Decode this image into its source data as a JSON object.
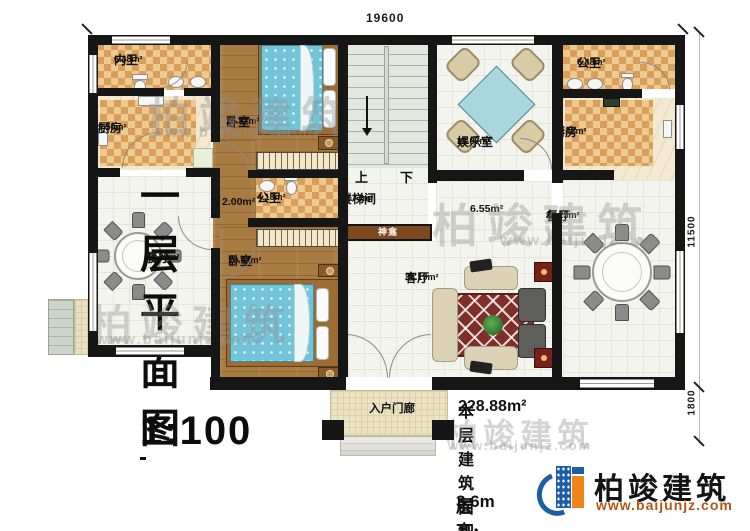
{
  "plan": {
    "dimensions": {
      "width_top": "19600",
      "height_right": "11500",
      "porch_right": "1800"
    },
    "rooms": {
      "inner_bath": {
        "name": "内卫",
        "area": "6.48m²"
      },
      "kitchen_left": {
        "name": "厨房",
        "area": "9.50m²"
      },
      "bedroom_top": {
        "name": "卧室",
        "area": "15.87m²"
      },
      "bath_center": {
        "name": "公卫",
        "area": "4.18m²"
      },
      "corridor_small": {
        "area": "2.00m²"
      },
      "stairwell": {
        "name": "楼梯间",
        "area": "16.73m²"
      },
      "shrine": {
        "name": "神龛"
      },
      "entertainment": {
        "name": "娱乐室",
        "area": "16.87m²"
      },
      "bath_right": {
        "name": "公卫",
        "area": "6.48m²"
      },
      "kitchen_right": {
        "name": "厨房",
        "area": "10.42m²"
      },
      "dining_left": {
        "name": "餐厅",
        "area": "22.23m²"
      },
      "bedroom_bottom": {
        "name": "卧室",
        "area": "19.64m²"
      },
      "living": {
        "name": "客厅",
        "area": "36.19m²"
      },
      "corridor_mid": {
        "area": "6.55m²"
      },
      "dining_right": {
        "name": "餐厅",
        "area": "22.23m²"
      },
      "porch": {
        "name": "入户门廊"
      }
    },
    "stairs": {
      "up": "上",
      "down": "下"
    }
  },
  "watermark": {
    "text": "柏竣建筑",
    "url": "www.baijunjz.com"
  },
  "footer": {
    "title": "一层平面图",
    "scale": "1:100",
    "area_label": "本层建筑面积:",
    "area_value": "228.88m²",
    "floor_height_label": "层高:",
    "floor_height_value": "3.6m"
  },
  "logo": {
    "name": "柏竣建筑",
    "url": "www.baijunjz.com"
  },
  "colors": {
    "accent_blue": "#1b5ea6",
    "accent_orange": "#f08519",
    "wall": "#161616"
  }
}
